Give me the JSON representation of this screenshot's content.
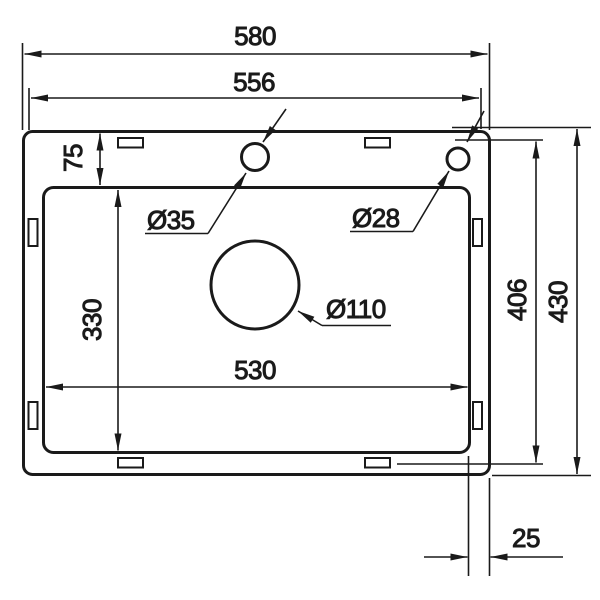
{
  "diagram": {
    "kind": "sink-installation-dimension-drawing",
    "dims": {
      "overall_width": "580",
      "upper_width": "556",
      "top_rim": "75",
      "faucet_hole": "Ø35",
      "accessory_hole": "Ø28",
      "drain_hole": "Ø110",
      "bowl_width": "530",
      "bowl_height": "330",
      "inner_height": "406",
      "overall_height": "430",
      "side_rim": "25"
    },
    "colors": {
      "line": "#1a1a1a",
      "background": "#ffffff"
    }
  }
}
